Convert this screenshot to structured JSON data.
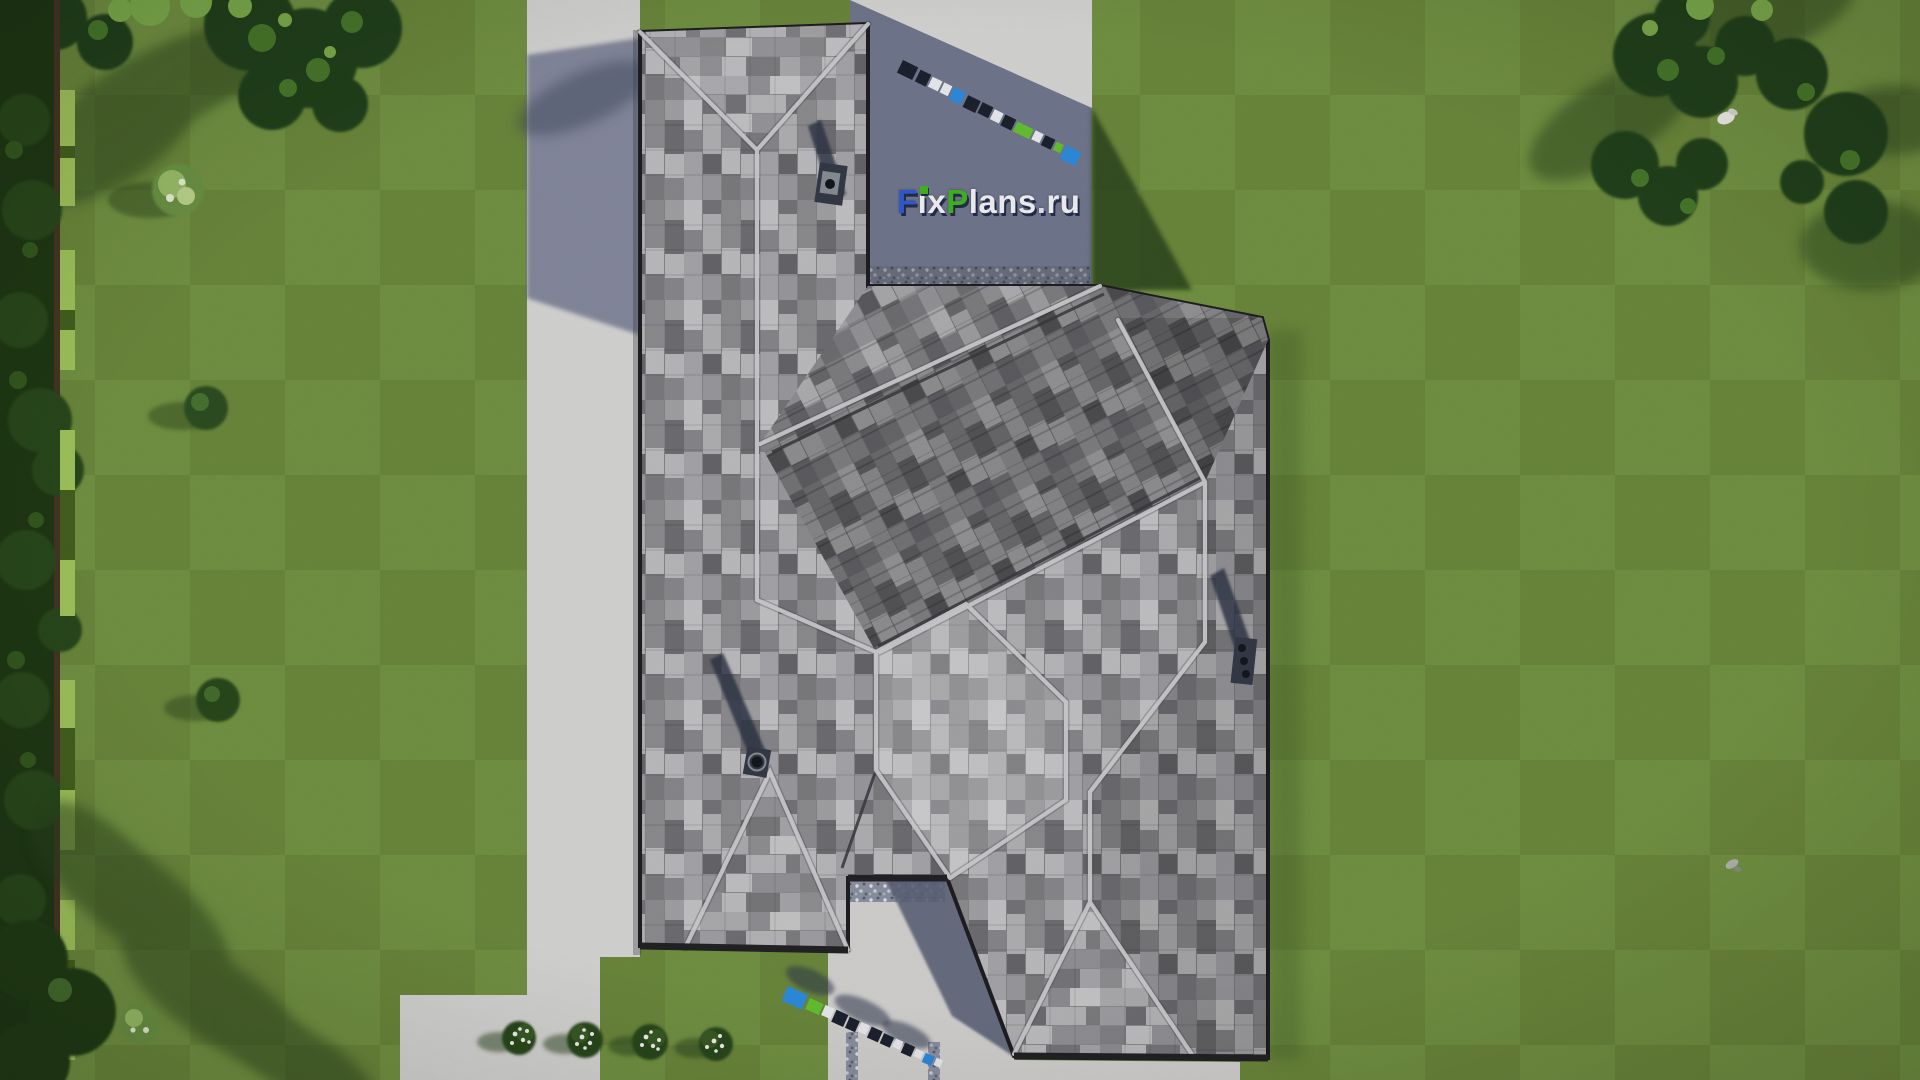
{
  "meta": {
    "description": "Aerial top-down 3D architectural render of a gray shingled hip-roof house on a mowed lawn",
    "view": "top-down bird's eye",
    "render_site_watermark": "FixPlans.ru"
  },
  "watermark": {
    "text": "FixPlans.ru",
    "letters": [
      {
        "ch": "F",
        "color": "#2f57c8"
      },
      {
        "ch": "i",
        "color": "#e9e9ec",
        "tittle": "#3fae1e"
      },
      {
        "ch": "x",
        "color": "#e9e9ec"
      },
      {
        "ch": "P",
        "color": "#3fae1e"
      },
      {
        "ch": "l",
        "color": "#e9e9ec"
      },
      {
        "ch": "a",
        "color": "#e9e9ec"
      },
      {
        "ch": "n",
        "color": "#e9e9ec"
      },
      {
        "ch": "s",
        "color": "#e9e9ec"
      },
      {
        "ch": ".",
        "color": "#d9d9df"
      },
      {
        "ch": "r",
        "color": "#e9e9ec"
      },
      {
        "ch": "u",
        "color": "#e9e9ec"
      }
    ],
    "shadow_color": "#161e3e",
    "brand_blue": "#2f57c8",
    "brand_green": "#3fae1e",
    "small_strip_colors": {
      "blue": "#2e8ee0",
      "green": "#66c431",
      "dark": "#1d2230",
      "white": "#eef0f4"
    }
  },
  "scene": {
    "objects": [
      {
        "name": "lawn",
        "color": "#708f3e"
      },
      {
        "name": "house-roof",
        "shingle_base": "#97979b"
      },
      {
        "name": "chimney-top",
        "count": 1
      },
      {
        "name": "chimney-left",
        "count": 1
      },
      {
        "name": "chimney-right-triple-flue",
        "count": 1
      },
      {
        "name": "concrete-path-left",
        "color": "#d9d9d7"
      },
      {
        "name": "entrance-pad-top",
        "color": "#d9d9d7"
      },
      {
        "name": "entrance-court-bottom",
        "color": "#d6d5d3"
      },
      {
        "name": "flower-bushes-white",
        "count": 4
      },
      {
        "name": "hedge-left-boundary",
        "color": "#9ec45e"
      },
      {
        "name": "trees-top-left"
      },
      {
        "name": "trees-top-right"
      },
      {
        "name": "tree-bottom-left"
      },
      {
        "name": "white-bird-on-tree"
      },
      {
        "name": "small-gray-object-on-lawn"
      }
    ],
    "lighting": "sun from lower-right, shadows cast to upper-left"
  },
  "palette": {
    "grass_mid": "#708f3e",
    "grass_dark": "#5e7d33",
    "shadow_green": "#2c431c",
    "foliage_dark": "#1f3a16",
    "foliage_mid": "#35591f",
    "foliage_light": "#7fb04e",
    "paving_light": "#d9d9d7",
    "paving_shadow": "#646b85",
    "shingle_light": "#c6c6c8",
    "shingle_mid": "#97979b",
    "shingle_dark": "#6e6e73",
    "ridge_light": "#d3d3d6",
    "chimney": "#353b47"
  }
}
